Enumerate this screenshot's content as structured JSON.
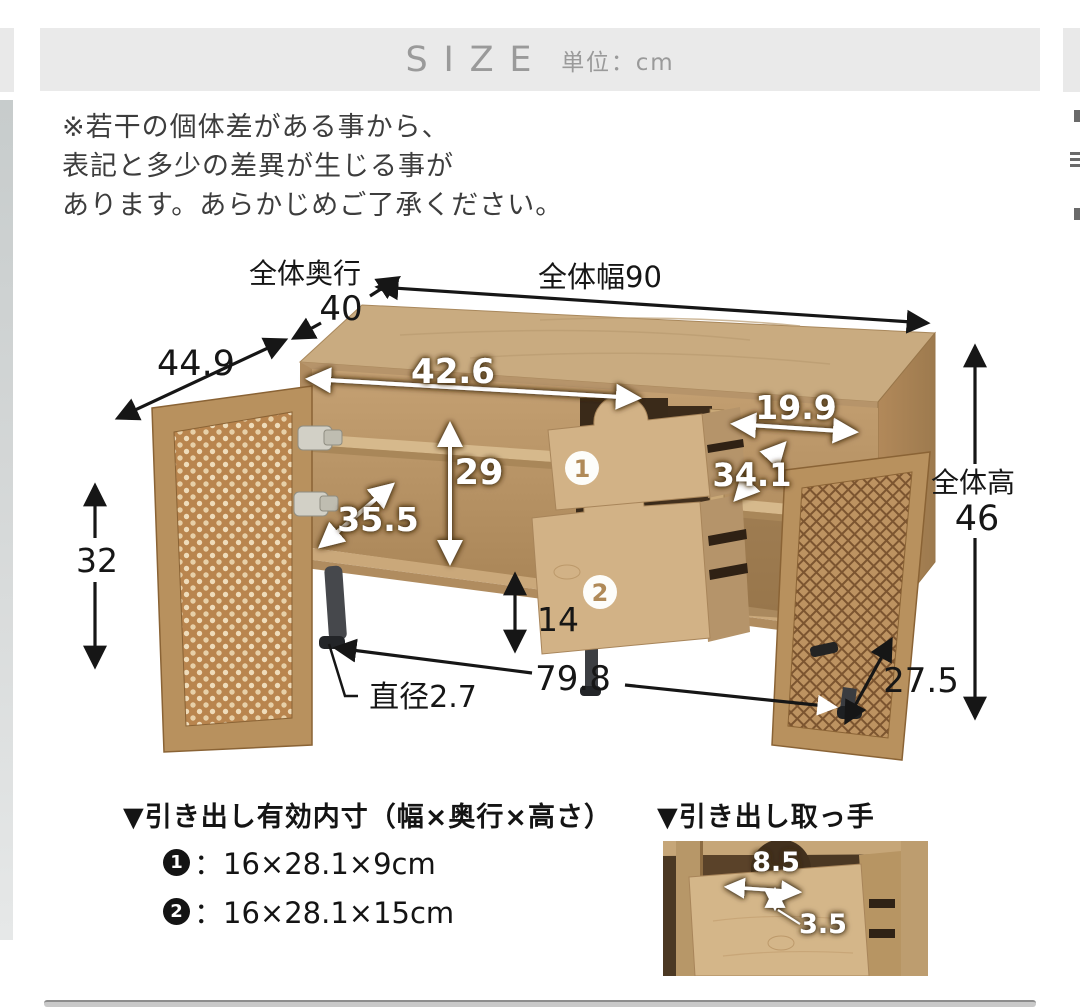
{
  "header": {
    "title": "SIZE",
    "unit": "単位：cm"
  },
  "disclaimer": {
    "line1": "※若干の個体差がある事から、",
    "line2": "表記と多少の差異が生じる事が",
    "line3": "あります。あらかじめご了承ください。"
  },
  "diagram": {
    "overall_width": "全体幅90",
    "overall_depth_label": "全体奥行",
    "overall_depth_value": "40",
    "open_door_depth": "44.9",
    "left_compartment_width": "42.6",
    "inner_height": "29",
    "inner_depth": "35.5",
    "door_height": "32",
    "right_compartment_width": "19.9",
    "right_compartment_depth": "34.1",
    "overall_height_label": "全体高",
    "overall_height_value": "46",
    "floor_clearance": "14",
    "leg_diameter": "直径2.7",
    "leg_span_width": "79.8",
    "leg_span_depth": "27.5",
    "drawer1_number": "1",
    "drawer2_number": "2"
  },
  "drawer_specs": {
    "heading": "▼引き出し有効内寸（幅×奥行×高さ）",
    "items": [
      {
        "number": "1",
        "dimensions": "：16×28.1×9cm"
      },
      {
        "number": "2",
        "dimensions": "：16×28.1×15cm"
      }
    ]
  },
  "handle_detail": {
    "heading": "▼引き出し取っ手",
    "handle_width": "8.5",
    "handle_depth": "3.5"
  },
  "colors": {
    "header_bg": "#eaeaea",
    "header_text": "#9a9a9a",
    "wood_light": "#c9ab80",
    "wood_mid": "#b99367",
    "rattan": "#b9854e",
    "leg": "#46484c",
    "dim_black": "#161616",
    "dim_white": "#ffffff"
  }
}
